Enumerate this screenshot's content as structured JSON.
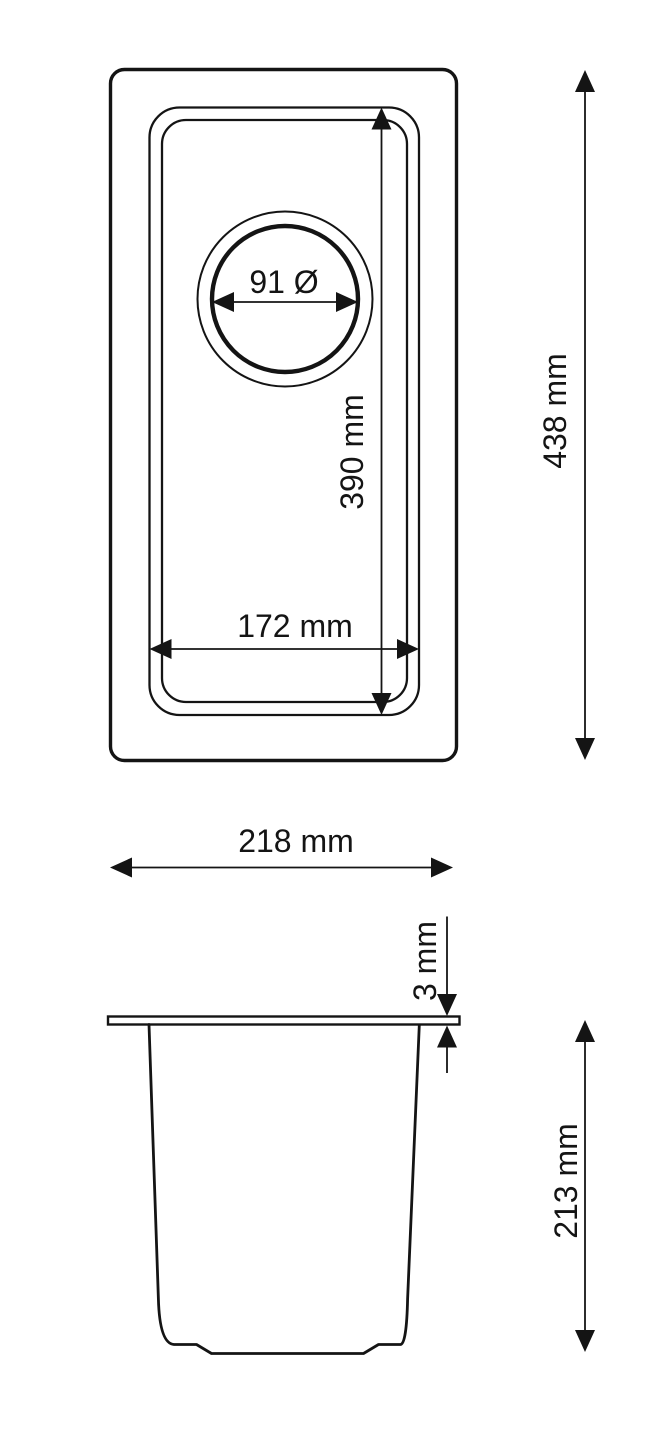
{
  "page": {
    "background_color": "#ffffff",
    "ink_color": "#141414",
    "drawing_type": "sink technical dimension drawing"
  },
  "top_view": {
    "labels": {
      "drain_diameter": "91 Ø",
      "bowl_length": "390 mm",
      "bowl_width": "172 mm",
      "overall_length": "438 mm"
    }
  },
  "side_view": {
    "labels": {
      "overall_width": "218 mm",
      "rim_thickness": "3 mm",
      "bowl_depth": "213 mm"
    }
  },
  "dimensions_mm": {
    "drain_diameter": 91,
    "bowl_length": 390,
    "bowl_width": 172,
    "overall_length": 438,
    "overall_width": 218,
    "rim_thickness": 3,
    "bowl_depth": 213
  }
}
